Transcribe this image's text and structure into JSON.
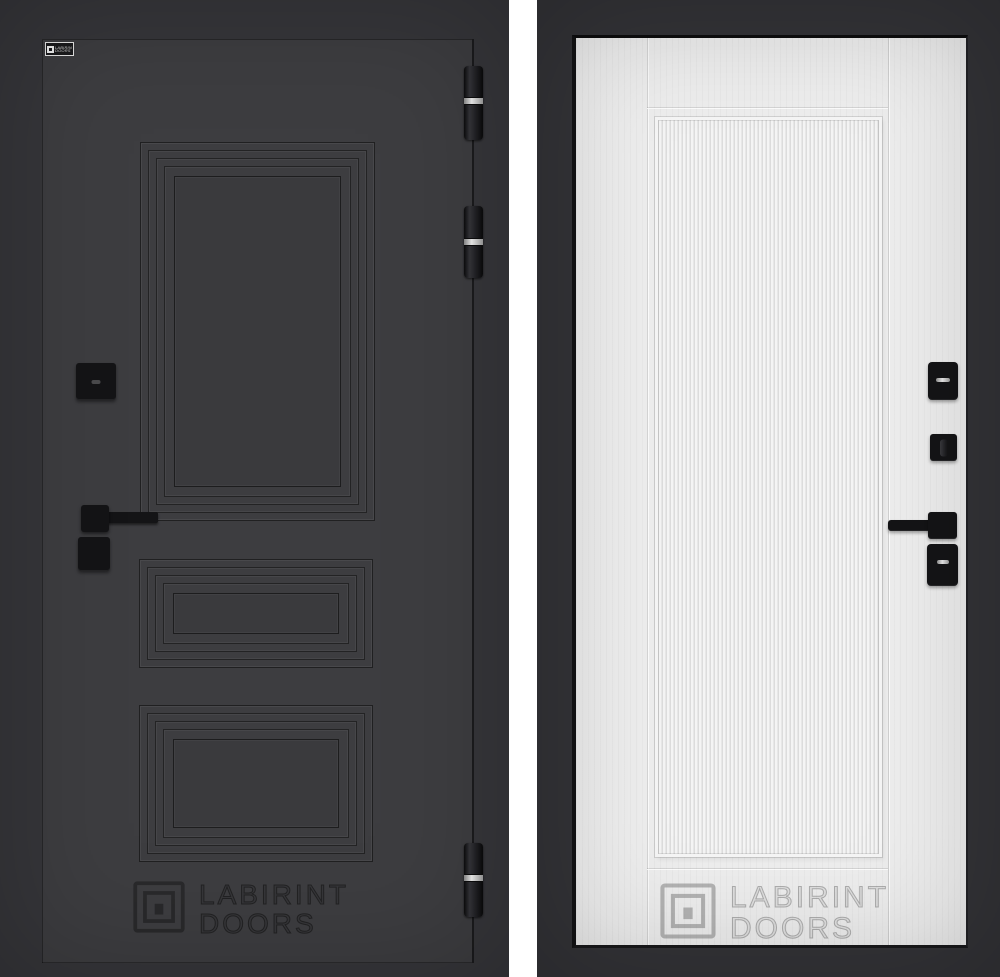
{
  "css_vars": {
    "--page-bg": "#ffffff",
    "--left-frame": "#36363a",
    "--left-leaf": "#3d3d40",
    "--left-leaf-inner": "#3a3a3d",
    "--left-line": "#1b1b1d",
    "--hardware-black": "#141416",
    "--hinge-ring": "#e0e0e0",
    "--right-frame": "#333337",
    "--right-leaf": "#ededed",
    "--rib-dark": "#dcdcdc",
    "--rib-light": "#f4f4f4",
    "--wm-dark-stroke": "rgba(18,18,18,0.6)",
    "--wm-light-stroke": "rgba(125,125,125,0.55)"
  },
  "brand_badge": {
    "line1": "LABIRINT",
    "line2": "DOORS"
  },
  "left_door": {
    "side": "exterior graphite door leaf",
    "watermark": {
      "line1": "LABIRINT",
      "line2": "DOORS"
    }
  },
  "right_door": {
    "side": "interior white fluted door leaf",
    "watermark": {
      "line1": "LABIRINT",
      "line2": "DOORS"
    }
  }
}
